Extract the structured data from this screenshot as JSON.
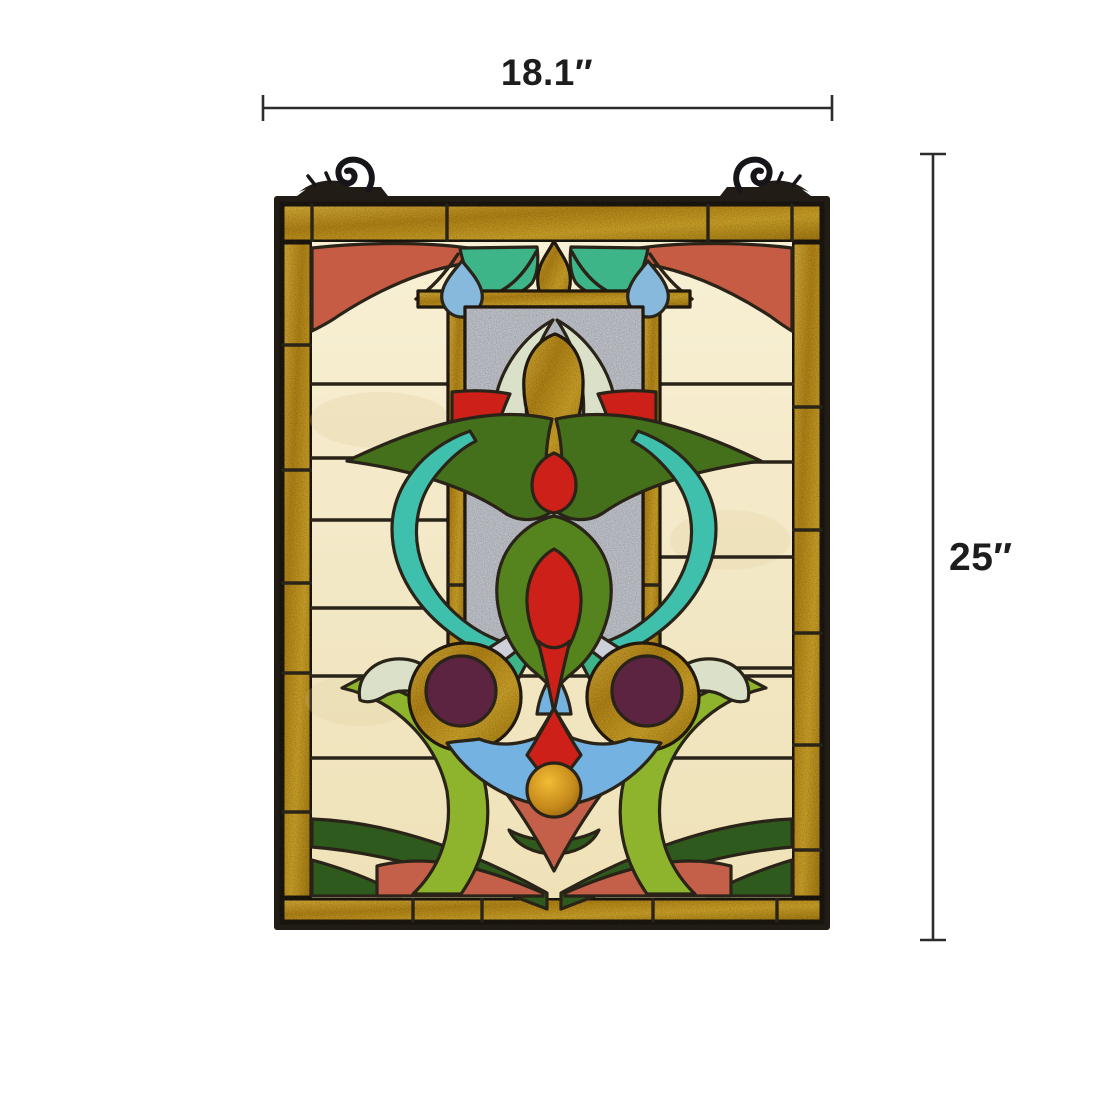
{
  "scene": {
    "description": "Tiffany-style stained glass hanging window panel product photo with size annotations",
    "background_color": "#ffffff"
  },
  "annotations": {
    "width_label": "18.1″",
    "height_label": "25″"
  },
  "panel": {
    "hook_icon": "scroll-hook-icon",
    "colors": {
      "lead": "#2a2318",
      "frame": "#211c16",
      "gold": "#c79a24",
      "cream": "#f4ead0",
      "coral": "#c75c44",
      "red": "#cc2018",
      "salmon": "#c4604a",
      "teal": "#3eb489",
      "aqua": "#3fc0ac",
      "sky_blue": "#74b2e2",
      "pale_blue": "#86b9dc",
      "dark_leaf": "#45701b",
      "heart_green": "#55831d",
      "lime": "#8db42c",
      "bottle_green": "#2f5a1d",
      "celadon": "#dbe1c9",
      "clear_glass": "#cdd0d8",
      "maroon": "#5c2440",
      "amber": "#d89a1d",
      "dimension_line": "#2c2c2c"
    }
  }
}
